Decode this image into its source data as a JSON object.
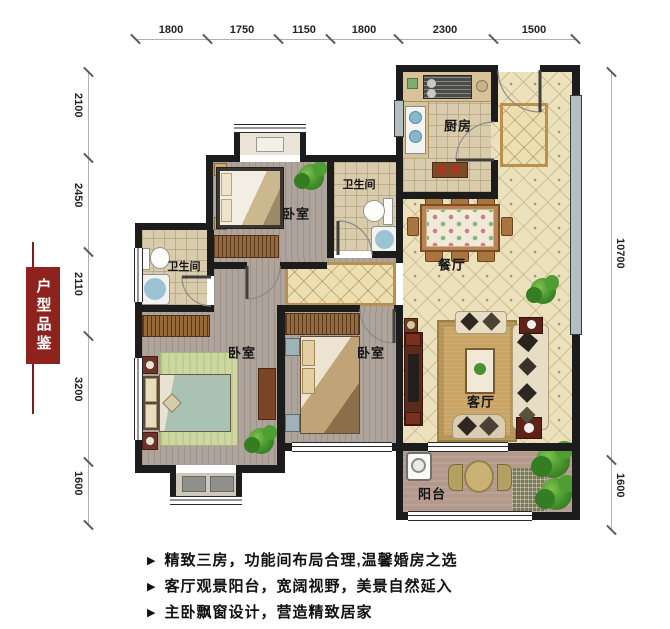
{
  "banner": {
    "text": "户型品鉴"
  },
  "dims": {
    "top": [
      "1800",
      "1750",
      "1150",
      "1800",
      "2300",
      "1500"
    ],
    "left": [
      "2100",
      "2450",
      "2110",
      "3200",
      "1600"
    ],
    "right": [
      "10700",
      "1600"
    ]
  },
  "rooms": {
    "kitchen": "厨房",
    "bath_top": "卫生间",
    "bath_left": "卫生间",
    "bedroom_top": "卧室",
    "bedroom_master": "卧室",
    "bedroom_mid": "卧室",
    "dining": "餐厅",
    "living": "客厅",
    "balcony": "阳台"
  },
  "features": {
    "bullet": "▶",
    "items": [
      "精致三房，功能间布局合理,温馨婚房之选",
      "客厅观景阳台，宽阔视野，美景自然延入",
      "主卧飘窗设计，营造精致居家"
    ]
  },
  "colors": {
    "banner_red": "#8e221c",
    "wall_black": "#1c1c1c",
    "tile_cream": "#ece1bd",
    "wood_gray": "#afa49b"
  }
}
